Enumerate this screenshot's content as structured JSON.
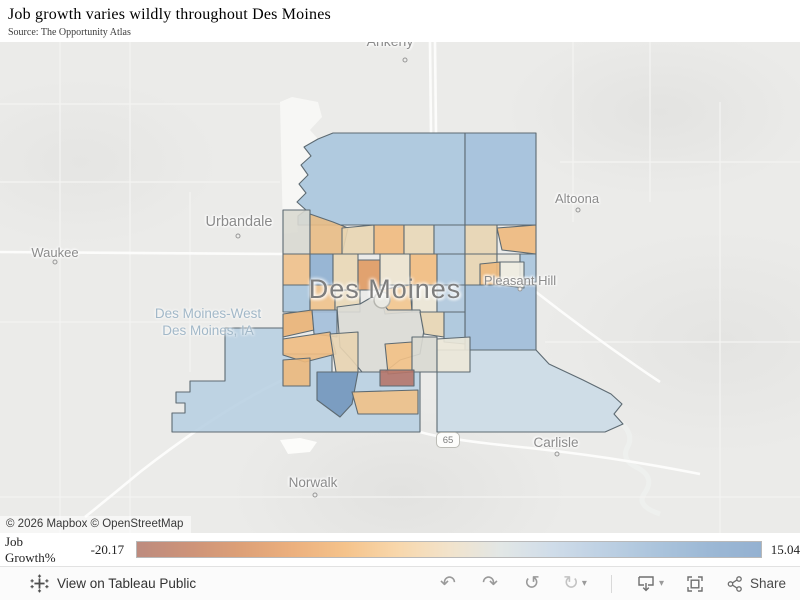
{
  "header": {
    "title": "Job growth varies wildly throughout Des Moines",
    "subtitle": "Source: The Opportunity Atlas"
  },
  "map": {
    "attribution": "© 2026 Mapbox © OpenStreetMap",
    "big_city_label": "Des Moines",
    "area_label_lines": [
      "Des Moines-West",
      "Des Moines, IA"
    ],
    "route_shield": "65",
    "cities": [
      {
        "name": "ankeny",
        "label": "Ankeny",
        "x": 390,
        "y": -9,
        "fs": 14,
        "dx": 405,
        "dy": 18
      },
      {
        "name": "urbandale",
        "label": "Urbandale",
        "x": 239,
        "y": 172,
        "fs": 14.5,
        "dx": 238,
        "dy": 194
      },
      {
        "name": "waukee",
        "label": "Waukee",
        "x": 55,
        "y": 203,
        "fs": 13,
        "dx": 55,
        "dy": 220
      },
      {
        "name": "altoona",
        "label": "Altoona",
        "x": 577,
        "y": 149,
        "fs": 13,
        "dx": 578,
        "dy": 168
      },
      {
        "name": "pleasant-hill",
        "label": "Pleasant Hill",
        "x": 520,
        "y": 231,
        "fs": 13,
        "dx": 520,
        "dy": 247
      },
      {
        "name": "carlisle",
        "label": "Carlisle",
        "x": 556,
        "y": 393,
        "fs": 13.5,
        "dx": 557,
        "dy": 412
      },
      {
        "name": "norwalk",
        "label": "Norwalk",
        "x": 313,
        "y": 433,
        "fs": 13.5,
        "dx": 315,
        "dy": 453
      }
    ],
    "tract_stroke": "#5d6a72",
    "tracts": [
      {
        "n": "sw-large",
        "f": "#b9d0e2",
        "p": "225,286 283,286 283,312 332,312 332,330 420,330 420,390 172,390 172,371 185,371 185,361 176,361 176,350 190,350 190,339 225,339"
      },
      {
        "n": "se-large",
        "f": "#ccdbe7",
        "p": "437,308 536,308 549,322 583,338 611,352 622,362 614,372 623,382 605,390 437,390"
      },
      {
        "n": "east-ph",
        "f": "#9fbcd9",
        "p": "465,243 536,243 536,308 465,308"
      },
      {
        "n": "nw-large",
        "f": "#aac6de",
        "p": "333,91 465,91 465,183 298,183 298,174 306,168 297,160 306,151 299,142 308,133 301,123 311,114 304,105 318,97"
      },
      {
        "n": "ne-large",
        "f": "#a2c0dc",
        "p": "465,91 536,91 536,183 465,183"
      },
      {
        "n": "a1",
        "f": "#d9d9d1",
        "p": "283,168 310,168 310,212 283,212"
      },
      {
        "n": "a2",
        "f": "#e9bd85",
        "p": "310,172 333,180 348,186 342,212 310,212"
      },
      {
        "n": "a3",
        "f": "#e9d6b3",
        "p": "342,186 374,183 374,212 342,212"
      },
      {
        "n": "a4",
        "f": "#f1ba7e",
        "p": "374,183 404,183 404,212 374,212"
      },
      {
        "n": "a5",
        "f": "#e9d8b8",
        "p": "404,183 434,183 434,212 404,212"
      },
      {
        "n": "a6",
        "f": "#b0c9de",
        "p": "434,183 465,183 465,212 434,212"
      },
      {
        "n": "a7",
        "f": "#e8d5b2",
        "p": "465,183 497,183 497,212 465,212"
      },
      {
        "n": "a8",
        "f": "#eeb97d",
        "p": "497,186 536,183 536,212 502,208"
      },
      {
        "n": "b1",
        "f": "#efc18b",
        "p": "283,212 310,212 310,243 283,243"
      },
      {
        "n": "b2",
        "f": "#8fb0d1",
        "p": "310,212 333,212 333,243 310,243"
      },
      {
        "n": "b3",
        "f": "#ead8b6",
        "p": "333,212 358,212 358,248 333,248"
      },
      {
        "n": "b4",
        "f": "#e09a62",
        "p": "358,218 380,218 380,248 358,248"
      },
      {
        "n": "b5",
        "f": "#ede4d0",
        "p": "380,212 410,212 410,243 380,243"
      },
      {
        "n": "b6",
        "f": "#f2bc80",
        "p": "410,212 437,212 437,243 410,243"
      },
      {
        "n": "b7",
        "f": "#adc8de",
        "p": "437,212 465,212 465,243 437,243"
      },
      {
        "n": "b8",
        "f": "#e8d5b3",
        "p": "465,212 497,212 497,243 465,243"
      },
      {
        "n": "b9",
        "f": "#eae7db",
        "p": "497,212 520,212 520,240 497,240"
      },
      {
        "n": "b10",
        "f": "#aac5dd",
        "p": "520,212 536,212 536,240 520,240"
      },
      {
        "n": "c1",
        "f": "#a9c5dd",
        "p": "283,243 310,243 310,270 283,270"
      },
      {
        "n": "c2",
        "f": "#f0c28b",
        "p": "310,243 335,243 335,270 310,270"
      },
      {
        "n": "c3",
        "f": "#ead9b8",
        "p": "335,248 360,248 360,270 335,270"
      },
      {
        "n": "c4",
        "f": "#f3c68e",
        "p": "380,248 410,243 412,270 385,272"
      },
      {
        "n": "c5",
        "f": "#ece7d6",
        "p": "412,243 437,243 437,270 412,270"
      },
      {
        "n": "c6",
        "f": "#b0c9de",
        "p": "437,243 465,243 465,270 437,270"
      },
      {
        "n": "ph1",
        "f": "#edba7e",
        "p": "480,222 500,220 500,243 480,243"
      },
      {
        "n": "ph2",
        "f": "#f0ede2",
        "p": "500,220 524,220 524,246 500,243"
      },
      {
        "n": "d1",
        "f": "#eab276",
        "p": "283,272 312,268 314,288 283,295"
      },
      {
        "n": "d2",
        "f": "#a3bfda",
        "p": "312,268 337,268 337,295 314,292"
      },
      {
        "n": "downtown",
        "f": "#dcdcd6",
        "p": "337,265 360,262 372,255 380,258 388,268 420,268 424,288 420,312 400,318 385,330 362,330 352,318 340,305"
      },
      {
        "n": "d3",
        "f": "#e8d6b4",
        "p": "420,270 444,270 444,295 424,292"
      },
      {
        "n": "d4",
        "f": "#abc6dd",
        "p": "444,270 465,270 465,302 444,300"
      },
      {
        "n": "e1",
        "f": "#f0bd82",
        "p": "283,297 330,290 336,312 305,320 283,313"
      },
      {
        "n": "e2",
        "f": "#e8d4b1",
        "p": "330,292 358,290 358,330 336,330"
      },
      {
        "n": "e3",
        "f": "#f2c186",
        "p": "385,302 412,300 412,330 388,332"
      },
      {
        "n": "e4",
        "f": "#d9d9d1",
        "p": "412,295 437,295 437,330 412,330"
      },
      {
        "n": "e5",
        "f": "#ece8d8",
        "p": "437,297 470,295 470,330 437,330"
      },
      {
        "n": "f-steel",
        "f": "#7397bd",
        "p": "317,330 358,330 352,362 340,375 317,358"
      },
      {
        "n": "f-red",
        "f": "#b5766a",
        "p": "380,328 414,328 414,344 380,344"
      },
      {
        "n": "f-orange",
        "f": "#f0c187",
        "p": "352,350 418,348 418,372 358,372"
      },
      {
        "n": "f-west",
        "f": "#edb97c",
        "p": "283,318 310,316 310,344 283,344"
      }
    ]
  },
  "legend": {
    "title": "Job Growth%",
    "min": "-20.17",
    "max": "15.04",
    "gradient_stops": [
      "#bd8b7e",
      "#cd9379",
      "#dda077",
      "#ecb07e",
      "#f5c38b",
      "#f8d7ab",
      "#f2e3cb",
      "#e2e7e6",
      "#cfdce9",
      "#bdd0e3",
      "#abc4dc",
      "#9cb8d5",
      "#94b1d1"
    ]
  },
  "toolbar": {
    "view_label": "View on Tableau Public",
    "share_label": "Share",
    "undo_glyph": "↶",
    "redo_glyph": "↷",
    "reset_glyph": "↺",
    "refresh_glyph": "↻",
    "caret_glyph": "▾"
  }
}
